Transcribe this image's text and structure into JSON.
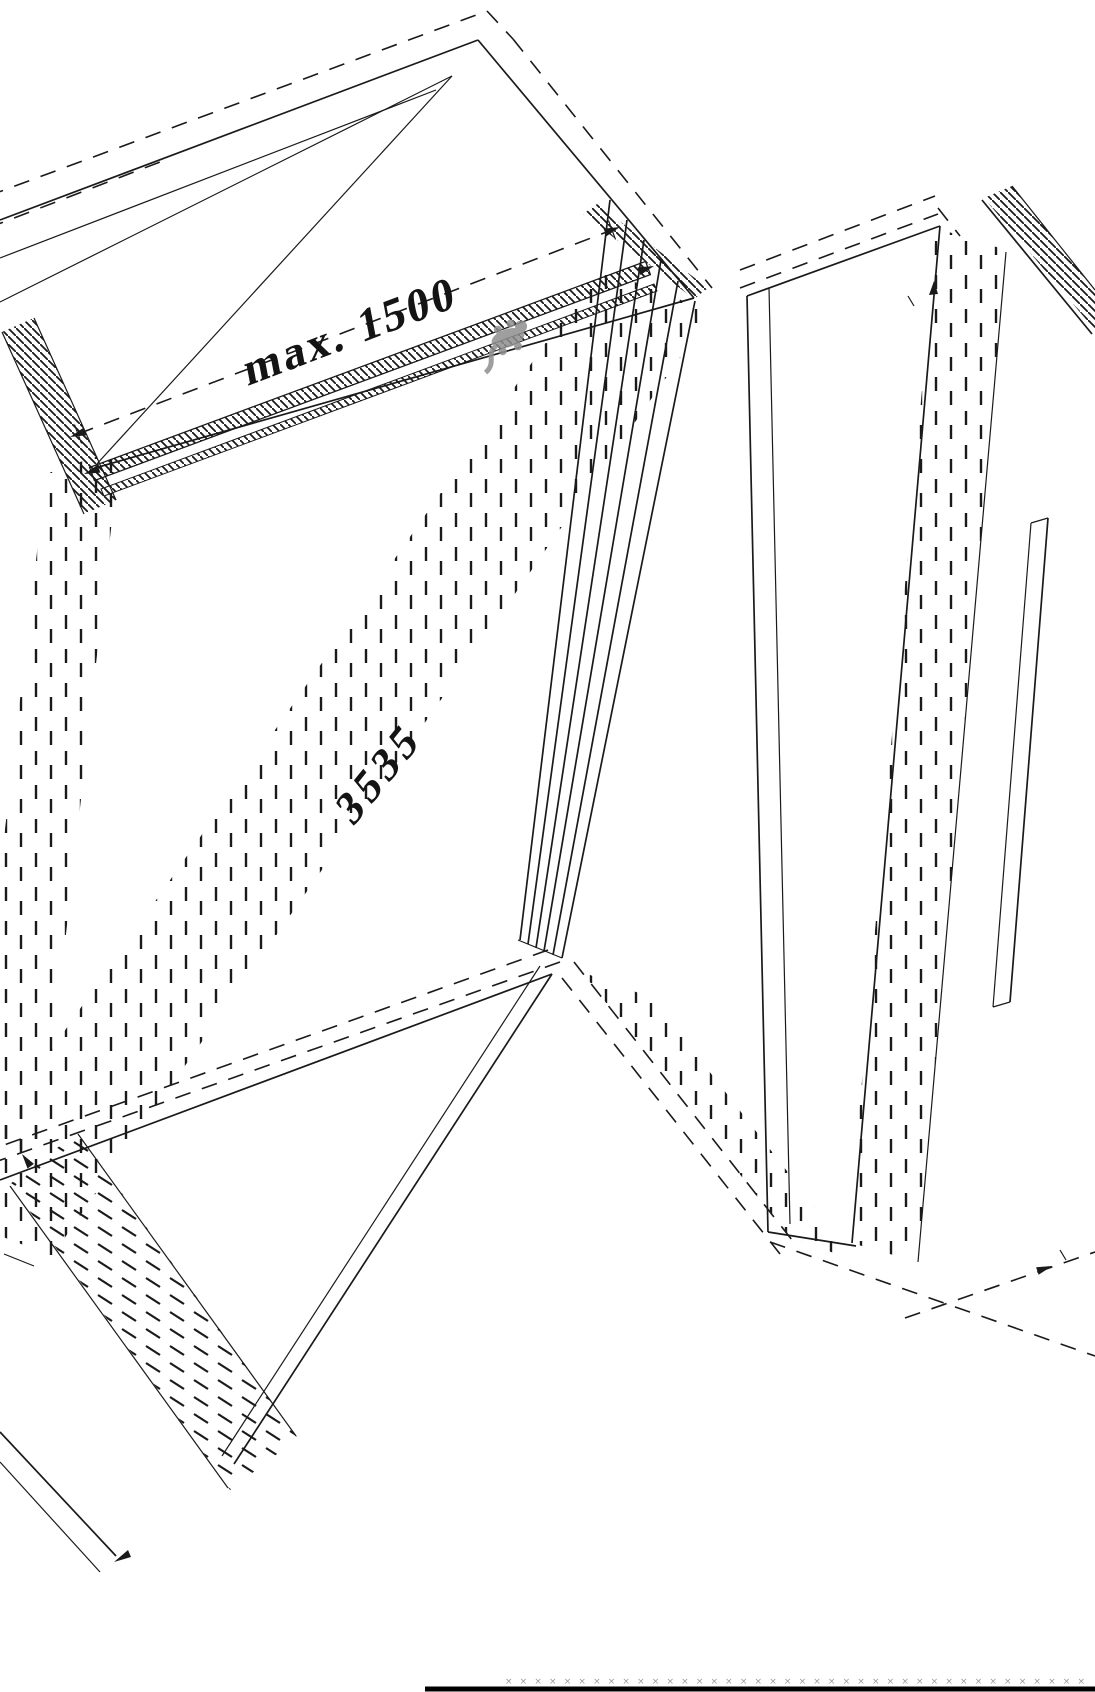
{
  "drawing": {
    "background": "#ffffff",
    "line_color": "#1a1a1a",
    "labels": {
      "max_width": "max. 1500",
      "mid_length": "3535"
    },
    "ground": {
      "marker": "×",
      "marker_count": 40,
      "marker_color": "#9a9a9a",
      "baseline_color": "#000000"
    },
    "watermark": {
      "name": "gecko-watermark",
      "color": "#8f8f8f"
    }
  }
}
